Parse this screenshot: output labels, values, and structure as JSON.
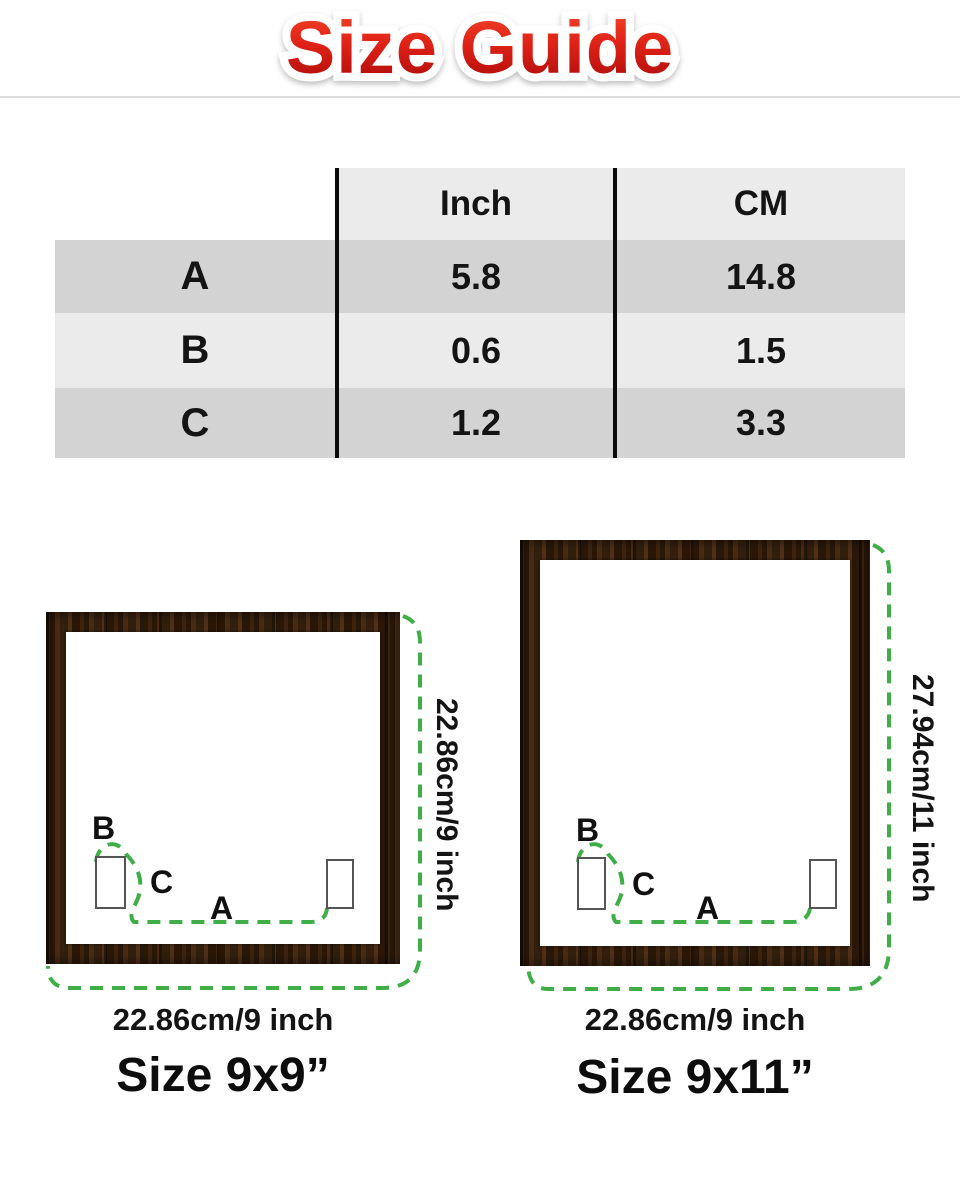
{
  "title": "Size Guide",
  "table": {
    "col_headers": {
      "inch": "Inch",
      "cm": "CM"
    },
    "rows": [
      {
        "label": "A",
        "inch": "5.8",
        "cm": "14.8"
      },
      {
        "label": "B",
        "inch": "0.6",
        "cm": "1.5"
      },
      {
        "label": "C",
        "inch": "1.2",
        "cm": "3.3"
      }
    ]
  },
  "frames": [
    {
      "name": "frame-9x9",
      "height_label": "22.86cm/9 inch",
      "width_label": "22.86cm/9 inch",
      "size_label": "Size 9x9”",
      "marker_a": "A",
      "marker_b": "B",
      "marker_c": "C"
    },
    {
      "name": "frame-9x11",
      "height_label": "27.94cm/11 inch",
      "width_label": "22.86cm/9 inch",
      "size_label": "Size 9x11”",
      "marker_a": "A",
      "marker_b": "B",
      "marker_c": "C"
    }
  ],
  "colors": {
    "accent_green": "#3fae47",
    "title_red_top": "#f2492a",
    "title_red_bottom": "#a80a0a",
    "table_row_dark": "#d3d3d3",
    "table_row_light": "#ebebeb",
    "wood_brown": "#34200f"
  }
}
